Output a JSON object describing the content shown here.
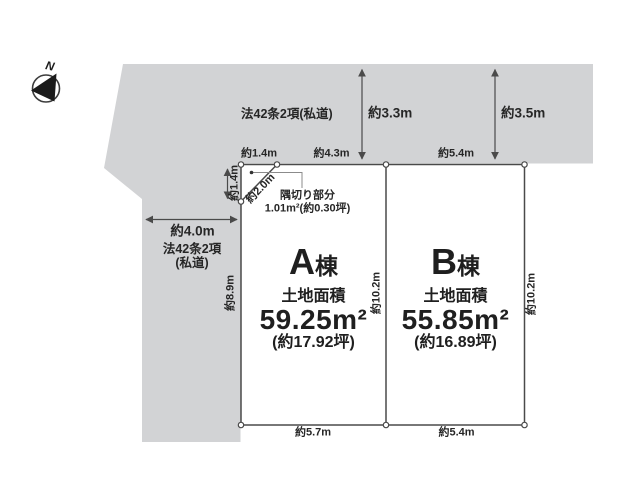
{
  "compass": {
    "north_label": "N"
  },
  "roads": {
    "top": {
      "label": "法42条2項(私道)",
      "width_left": "約3.3m",
      "width_right": "約3.5m"
    },
    "left": {
      "label_line1": "法42条2項",
      "label_line2": "(私道)",
      "width": "約4.0m"
    }
  },
  "corner_cut": {
    "title": "隅切り部分",
    "area": "1.01m²(約0.30坪)",
    "edge_top": "約1.4m",
    "edge_left": "約1.4m",
    "edge_diagonal": "約2.0m"
  },
  "dimensions": {
    "left_boundary_depth": "約8.9m"
  },
  "plots": [
    {
      "name_letter": "A",
      "name_suffix": "棟",
      "area_caption": "土地面積",
      "area_m2": "59.25m²",
      "area_tsubo": "(約17.92坪)",
      "frontage_top": "約4.3m",
      "frontage_bottom": "約5.7m",
      "depth": "約10.2m"
    },
    {
      "name_letter": "B",
      "name_suffix": "棟",
      "area_caption": "土地面積",
      "area_m2": "55.85m²",
      "area_tsubo": "(約16.89坪)",
      "frontage_top": "約5.4m",
      "frontage_bottom": "約5.4m",
      "depth": "約10.2m"
    }
  ],
  "colors": {
    "road_fill": "#d2d3d5",
    "line": "#4a4a4a",
    "text": "#262626"
  }
}
